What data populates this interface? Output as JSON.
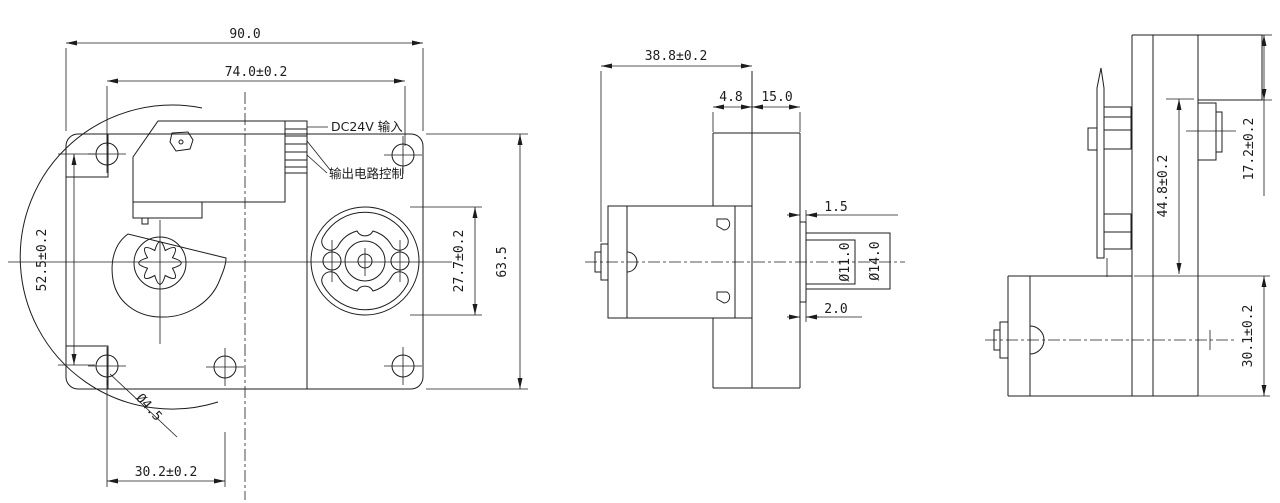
{
  "drawing": {
    "type": "engineering-3-view",
    "colors": {
      "line": "#1c1c1c",
      "background": "#ffffff"
    },
    "front_view": {
      "dim_overall_width": "90.0",
      "dim_mount_hole_span_h": "74.0±0.2",
      "dim_mount_hole_span_v": "52.5±0.2",
      "dim_bottom_hole_span": "30.2±0.2",
      "label_mount_hole_dia": "Ø4.5",
      "dim_plate_height": "63.5",
      "dim_pump_head_dia": "27.7±0.2",
      "label_power_input": "DC24V 输入",
      "label_output_control": "输出电路控制"
    },
    "side_view": {
      "dim_depth": "38.8±0.2",
      "dim_flange_lip": "4.8",
      "dim_flange_width": "15.0",
      "dim_shaft_step_top": "1.5",
      "dim_shaft_dia": "Ø11.0",
      "dim_boss_dia": "Ø14.0",
      "dim_shaft_step_bottom": "2.0"
    },
    "end_view": {
      "dim_boss_offset": "17.2±0.2",
      "dim_face_to_motor": "44.8±0.2",
      "dim_motor_height": "30.1±0.2"
    }
  }
}
